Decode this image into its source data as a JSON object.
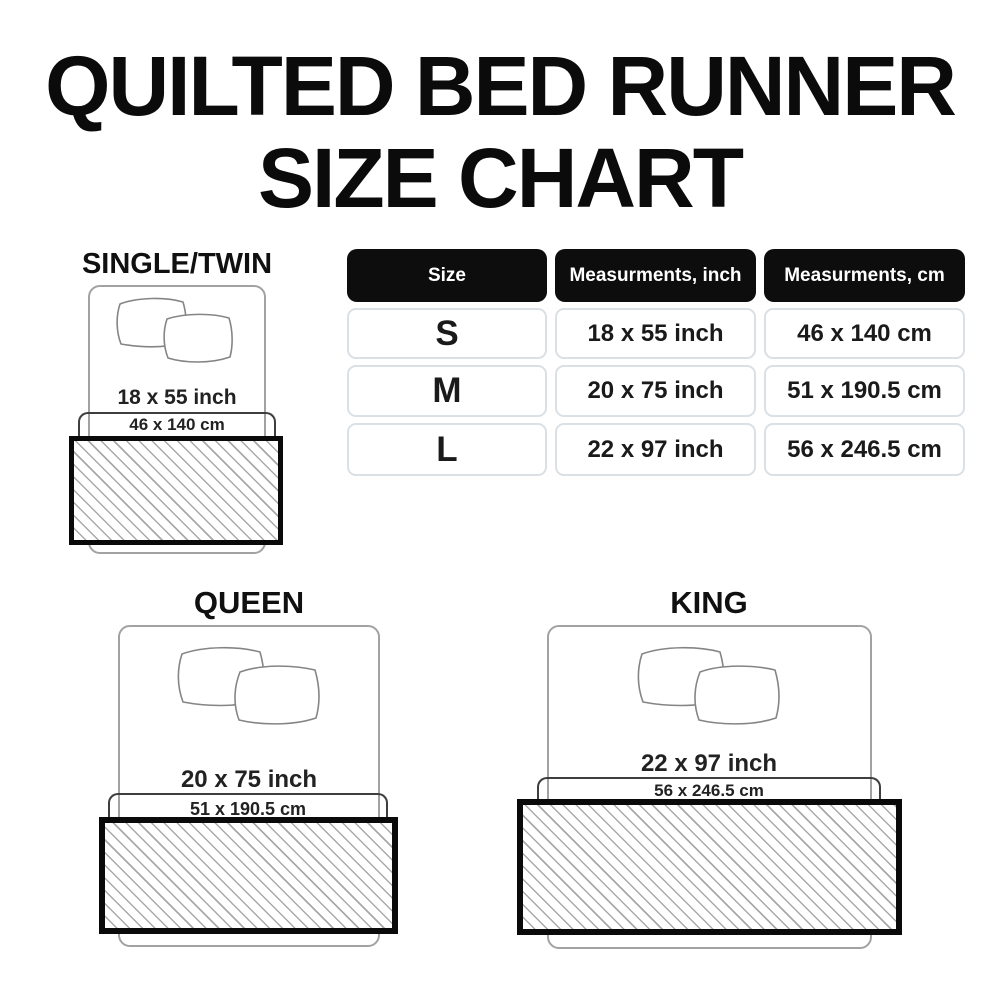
{
  "title": {
    "line1": "QUILTED BED RUNNER",
    "line2": "SIZE CHART"
  },
  "table": {
    "headers": {
      "size": "Size",
      "inch": "Measurments, inch",
      "cm": "Measurments, cm"
    },
    "rows": [
      {
        "size": "S",
        "inch": "18 x 55 inch",
        "cm": "46 x 140 cm"
      },
      {
        "size": "M",
        "inch": "20 x 75 inch",
        "cm": "51 x 190.5 cm"
      },
      {
        "size": "L",
        "inch": "22 x 97 inch",
        "cm": "56 x 246.5 cm"
      }
    ]
  },
  "diagrams": {
    "single": {
      "label": "SINGLE/TWIN",
      "inch": "18 x 55 inch",
      "cm": "46 x 140 cm",
      "icon": "pillows-icon"
    },
    "queen": {
      "label": "QUEEN",
      "inch": "20 x 75 inch",
      "cm": "51 x 190.5 cm",
      "icon": "pillows-icon"
    },
    "king": {
      "label": "KING",
      "inch": "22 x 97 inch",
      "cm": "56 x 246.5 cm",
      "icon": "pillows-icon"
    }
  },
  "colors": {
    "header_bg": "#0d0d0d",
    "header_text": "#ffffff",
    "cell_border": "#dbe0e5",
    "text": "#1a1a1a",
    "bed_outline": "#a2a2a2",
    "bracket": "#3e3e3e",
    "runner_border": "#0a0a0a",
    "hatch_line": "#a9a9a9"
  }
}
